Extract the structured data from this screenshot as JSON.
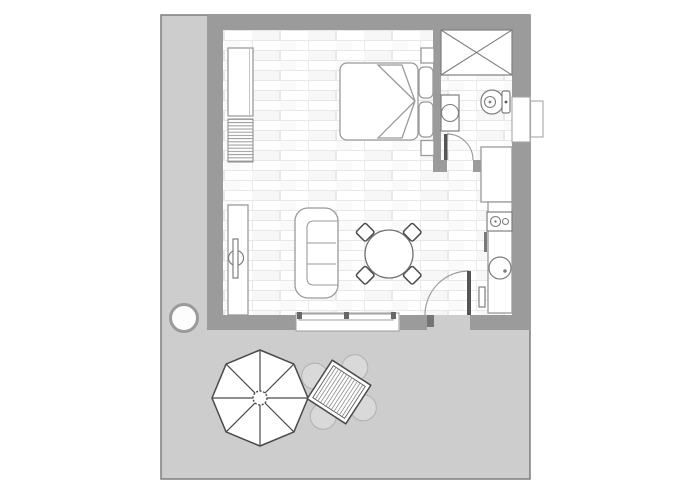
{
  "scene": {
    "kind": "apartment-floor-plan-with-patio",
    "visible_text": "",
    "areas": [
      "main-room",
      "bathroom",
      "patio"
    ]
  },
  "colors": {
    "page_background": "#ffffff",
    "patio_fill": "#cdcdcd",
    "patio_border": "#7d7d7d",
    "wall_fill": "#9b9b9b",
    "floor_fill": "#ffffff",
    "floor_plank_line": "#e8e8e8",
    "light_fixture_stroke": "#9a9a9a",
    "dark_fixture_stroke": "#4a4a4a",
    "door_leaf": "#555555",
    "outdoor_chair_fill": "#d9d9d9",
    "mullion": "#666666"
  },
  "plan": {
    "main_room_items": [
      {
        "name": "wardrobe",
        "count": 1
      },
      {
        "name": "radiator",
        "count": 1
      },
      {
        "name": "double-bed",
        "count": 1
      },
      {
        "name": "pillow",
        "count": 2
      },
      {
        "name": "bedside-shelf",
        "count": 2
      },
      {
        "name": "tv-unit",
        "count": 1
      },
      {
        "name": "sofa-3-seat",
        "count": 1
      },
      {
        "name": "round-dining-table",
        "count": 1
      },
      {
        "name": "dining-chair",
        "count": 4
      },
      {
        "name": "kitchen-tall-unit",
        "count": 1
      },
      {
        "name": "kitchen-counter",
        "count": 1
      },
      {
        "name": "stove-burner",
        "count": 2
      },
      {
        "name": "kitchen-sink",
        "count": 1
      },
      {
        "name": "entry-door",
        "count": 1
      },
      {
        "name": "window",
        "count": 1
      }
    ],
    "bathroom_items": [
      {
        "name": "shower",
        "count": 1
      },
      {
        "name": "toilet",
        "count": 1
      },
      {
        "name": "washbasin",
        "count": 1
      },
      {
        "name": "bathroom-door",
        "count": 1
      },
      {
        "name": "bathroom-window",
        "count": 1
      }
    ],
    "patio_items": [
      {
        "name": "parasol-octagonal",
        "count": 1
      },
      {
        "name": "outdoor-table-square",
        "count": 1
      },
      {
        "name": "outdoor-chair",
        "count": 4
      },
      {
        "name": "plant-pot",
        "count": 1
      }
    ]
  }
}
